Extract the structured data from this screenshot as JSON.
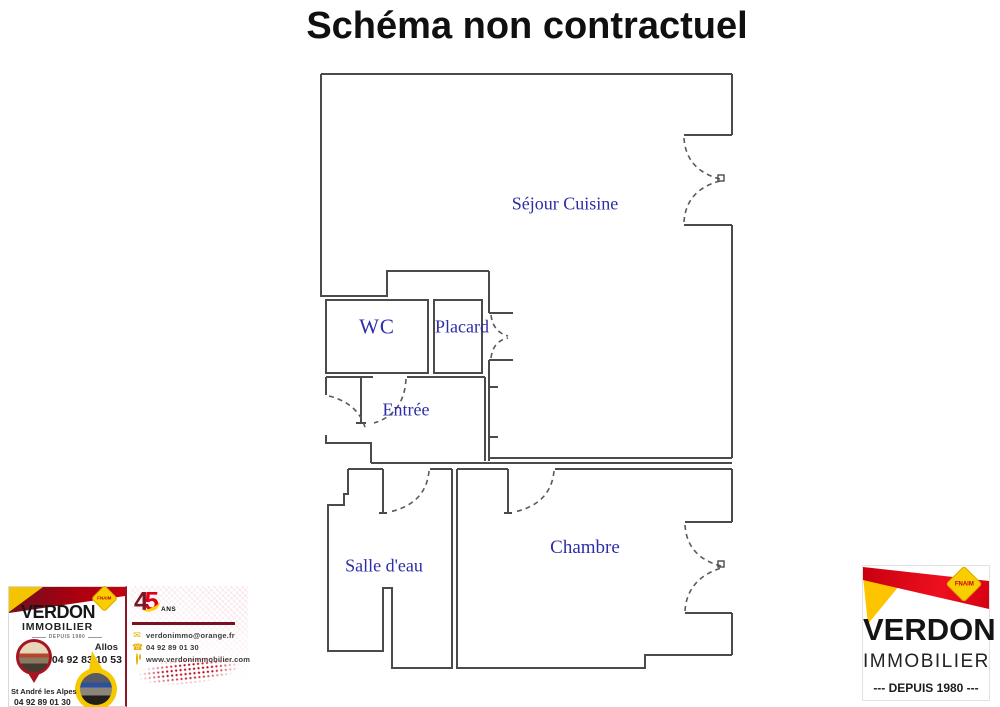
{
  "title": "Schéma non contractuel",
  "floorplan": {
    "rooms": [
      {
        "label": "Séjour Cuisine"
      },
      {
        "label": "WC"
      },
      {
        "label": "Placard"
      },
      {
        "label": "Entrée"
      },
      {
        "label": "Salle d'eau"
      },
      {
        "label": "Chambre"
      }
    ],
    "label_color": "#2d2da8",
    "wall_color": "#4b4b4b"
  },
  "agency_left": {
    "brand_line1": "VERDON",
    "brand_line2": "IMMOBILIER",
    "since_label": "DEPUIS 1980",
    "fnaim_label": "FNAIM",
    "anniversary_number_left": "4",
    "anniversary_number_right": "5",
    "anniversary_unit": "ANS",
    "office_allos": {
      "city": "Allos",
      "phone": "04 92 83 10 53"
    },
    "office_st_andre": {
      "city": "St André les Alpes",
      "phone": "04 92 89 01 30"
    },
    "contact": {
      "email": "verdonimmo@orange.fr",
      "phone": "04 92 89 01 30",
      "website": "www.verdonimmobilier.com"
    },
    "icons": {
      "email": "envelope-icon",
      "phone": "phone-icon",
      "website": "globe-icon"
    }
  },
  "agency_right": {
    "brand_line1": "VERDON",
    "brand_line2": "IMMOBILIER",
    "since_label": "--- DEPUIS 1980 ---",
    "fnaim_label": "FNAIM"
  },
  "colors": {
    "brand_red": "#e00016",
    "brand_maroon": "#7c1322",
    "brand_yellow": "#ffcc00",
    "title_color": "#101010"
  }
}
